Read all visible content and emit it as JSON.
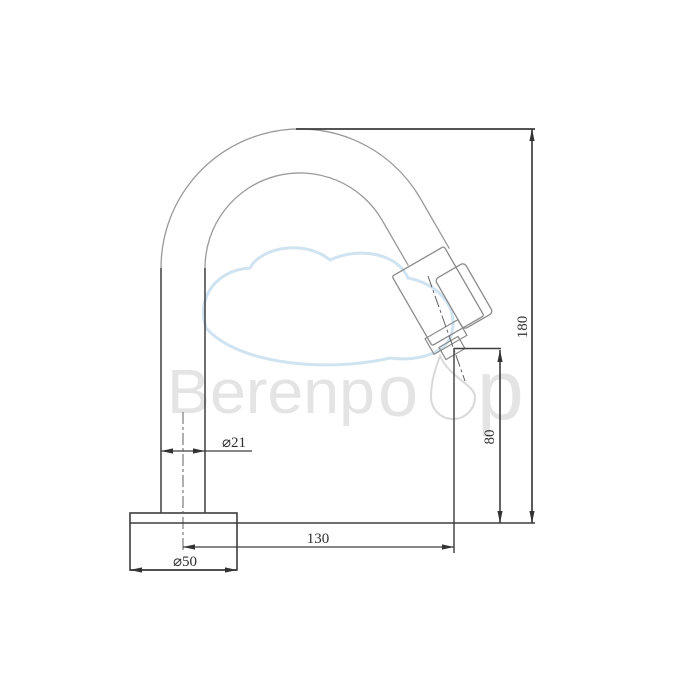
{
  "drawing": {
    "subject": "faucet-technical-drawing",
    "background_color": "#ffffff",
    "outline_color": "#9a9a9a",
    "solid_line_color": "#3d3d3d",
    "centerline_color": "#5f5f5f",
    "text_color": "#2f2f2f"
  },
  "watermark": {
    "brand": "Berenpop",
    "text_before_drop": "Berenp",
    "text_o": "o",
    "text_after_drop": "p",
    "text_color": "#e4e4e4",
    "cloud_color": "#cfe3f1",
    "drop_outline_color": "#d9d9d9"
  },
  "dimensions": {
    "spout_tube_diameter": {
      "label": "⌀21"
    },
    "base_diameter": {
      "label": "⌀50"
    },
    "spout_reach": {
      "label": "130"
    },
    "outlet_height": {
      "label": "80"
    },
    "total_height": {
      "label": "180"
    }
  }
}
